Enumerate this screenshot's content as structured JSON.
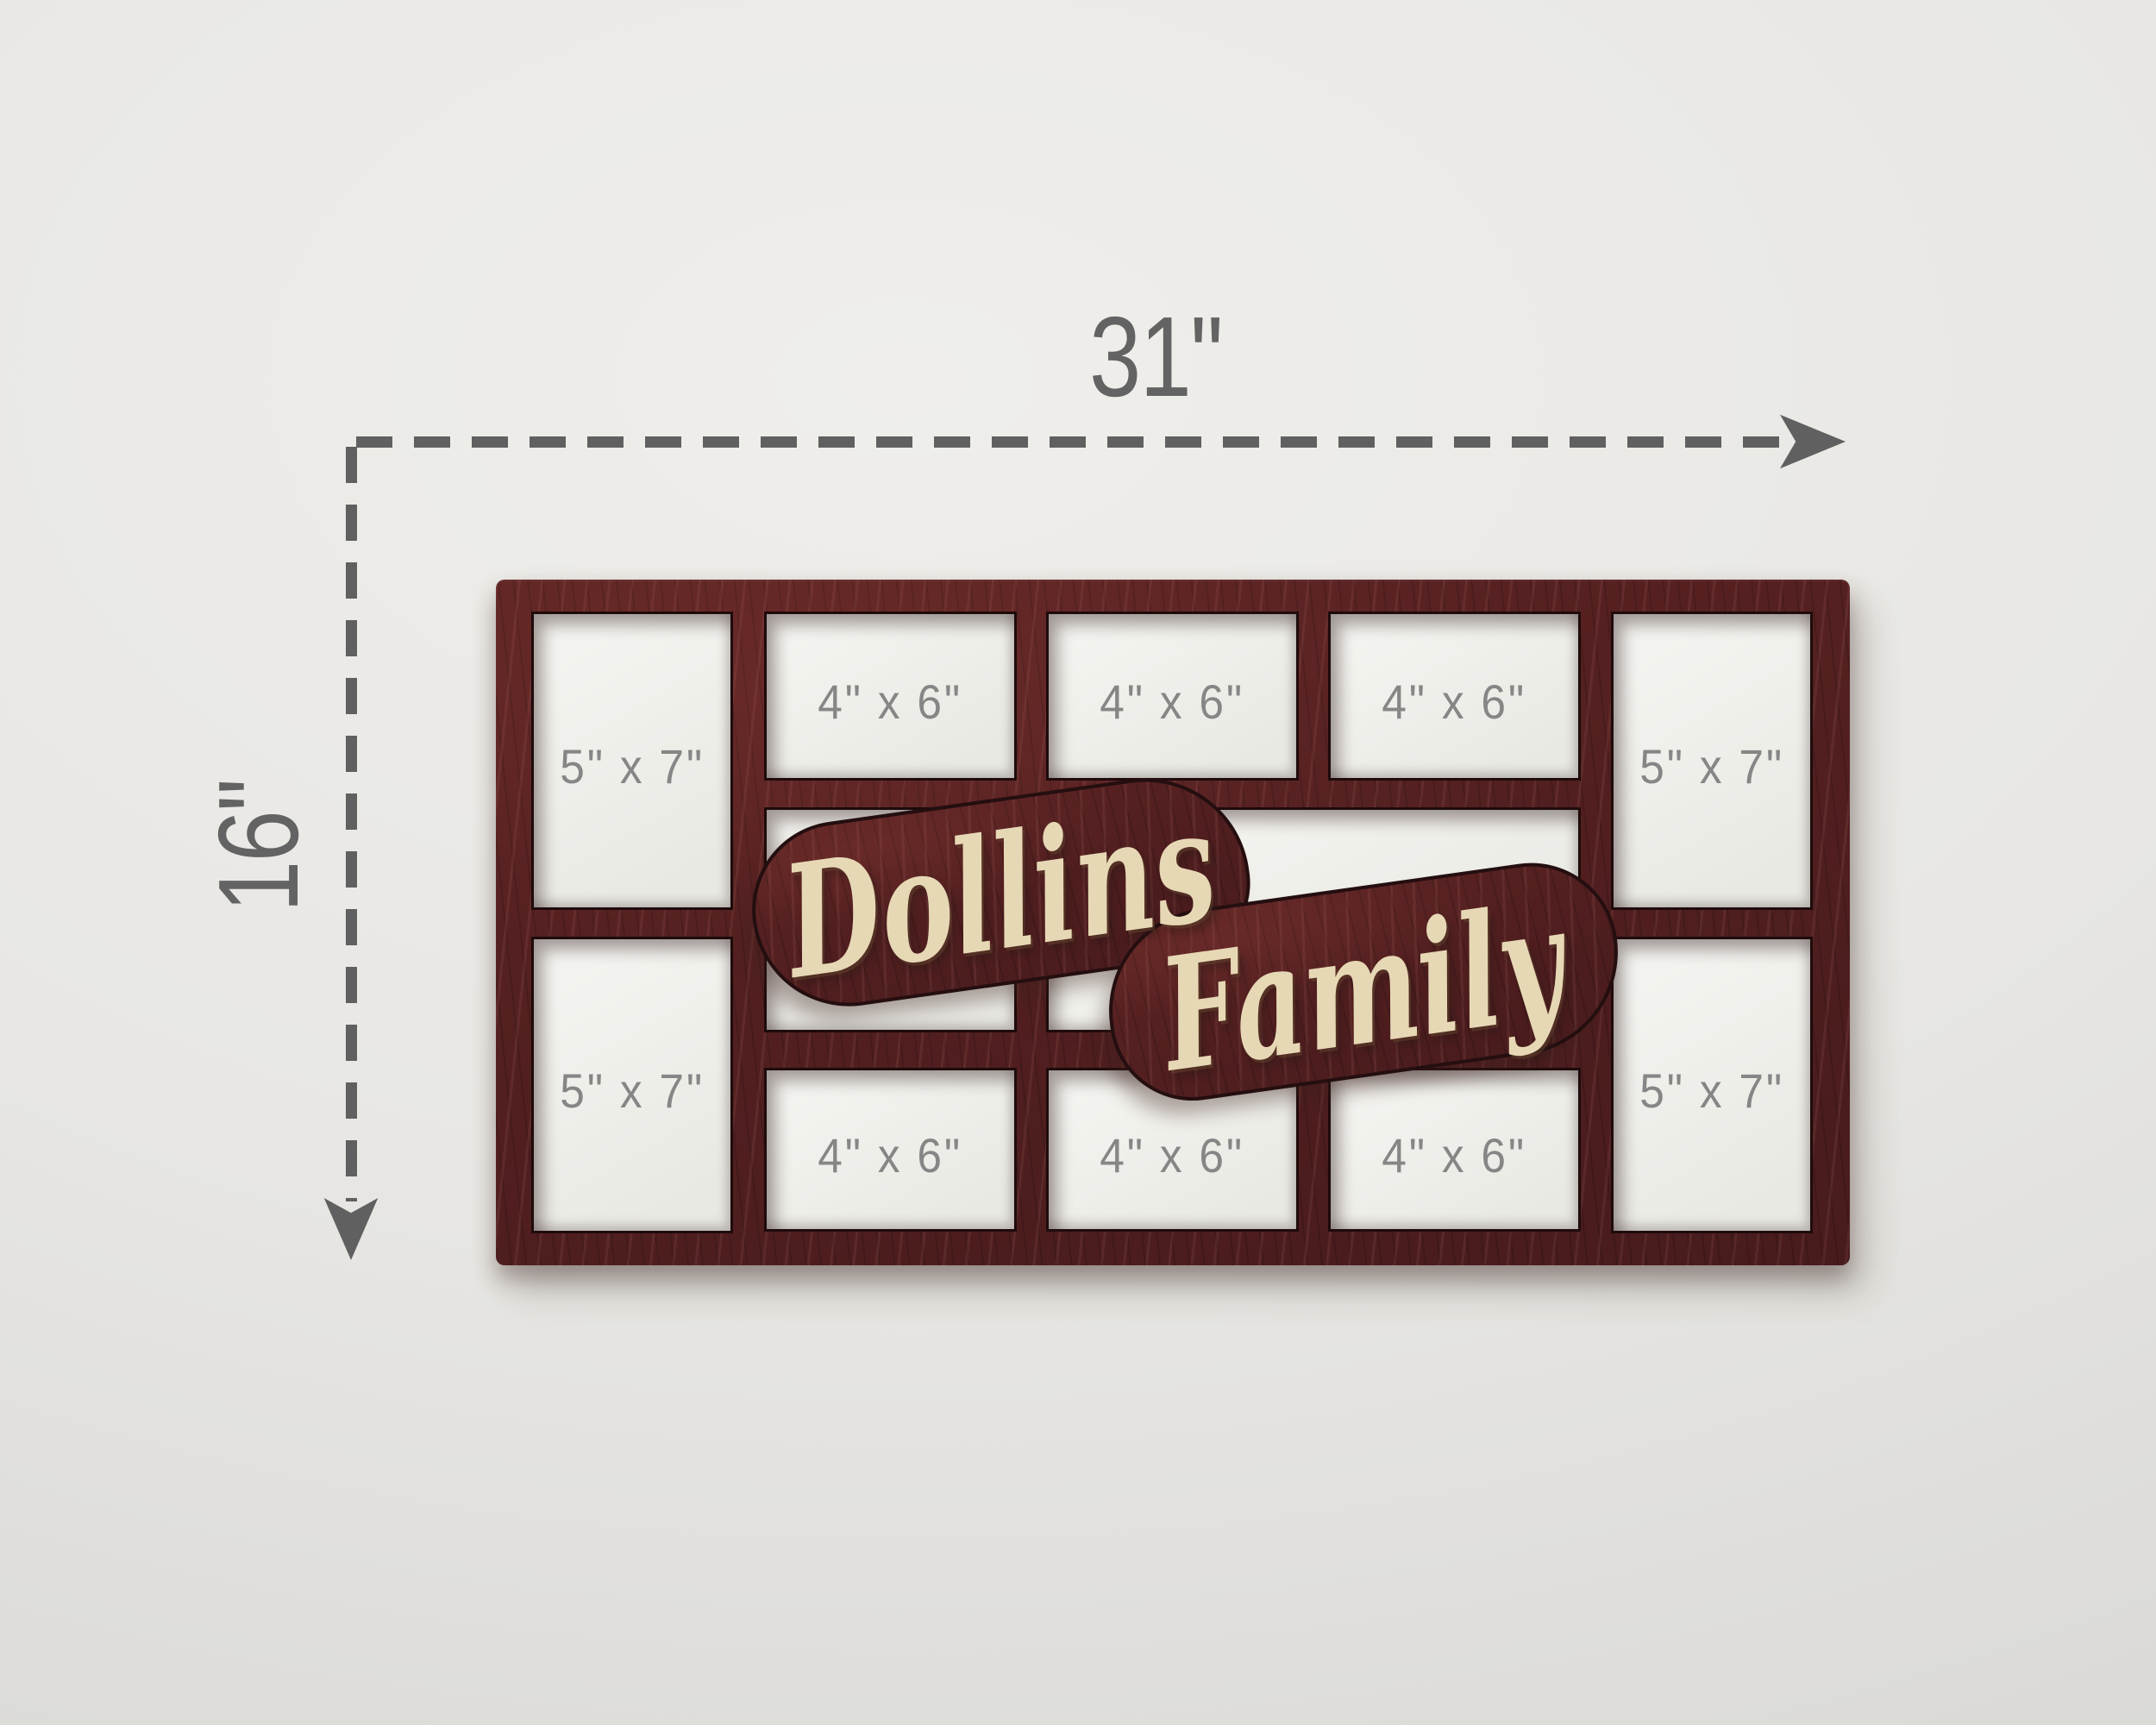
{
  "dimensions": {
    "width_label": "31\"",
    "height_label": "16\""
  },
  "plaque": {
    "line1": "Dollins",
    "line2": "Family"
  },
  "openings": {
    "corners": [
      "5\" x 7\"",
      "5\" x 7\"",
      "5\" x 7\"",
      "5\" x 7\""
    ],
    "top_row": [
      "4\" x 6\"",
      "4\" x 6\"",
      "4\" x 6\""
    ],
    "bottom_row": [
      "4\" x 6\"",
      "4\" x 6\"",
      "4\" x 6\""
    ]
  },
  "colors": {
    "wood": "#521f20",
    "wood_cut_edge": "#1f0b0c",
    "script_cream": "#e7d8b5",
    "dimension_gray": "#606060",
    "size_label_gray": "#868686",
    "opening_white": "#f0f0ec",
    "wall": "#e8e7e3"
  }
}
